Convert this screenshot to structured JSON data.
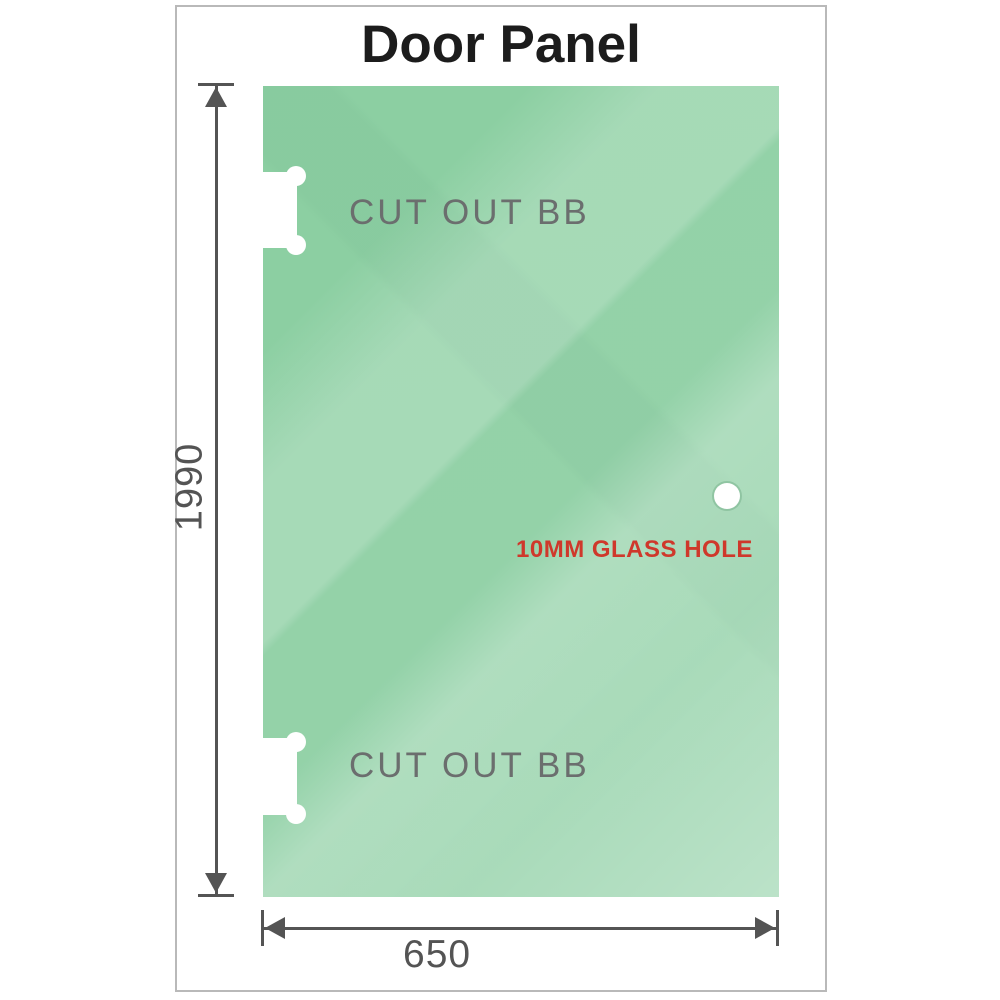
{
  "title": "Door Panel",
  "panel": {
    "cutout_top_label": "CUT OUT BB",
    "cutout_bottom_label": "CUT OUT BB",
    "glass_hole_label": "10MM GLASS HOLE"
  },
  "dimensions": {
    "height_label": "1990",
    "width_label": "650"
  },
  "icons": {
    "hinge_cutout": "dog-bone-notch",
    "glass_hole": "white-circle",
    "dimension_arrows": "double-ended-arrow"
  },
  "colors": {
    "glass_green": "#8ecfa4",
    "glass_green_deep": "#8ccfa2",
    "dimension_gray": "#545454",
    "label_gray": "#6b6e6e",
    "annotation_red": "#cf382b",
    "frame_gray": "#b9b9b9",
    "title_black": "#1c1c1c"
  }
}
